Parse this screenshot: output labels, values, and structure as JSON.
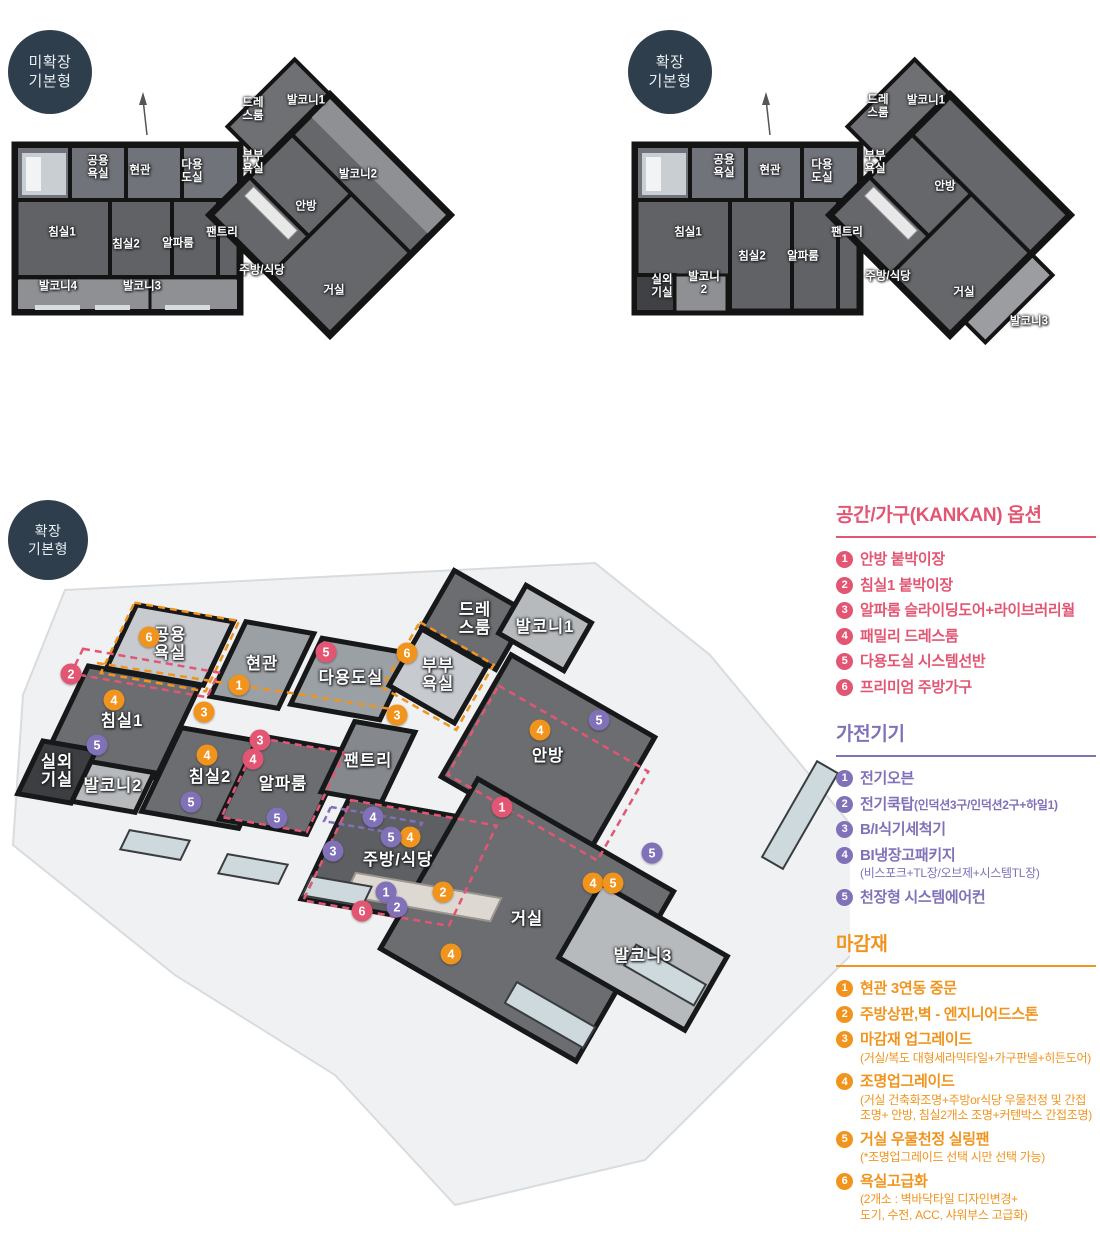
{
  "badges": {
    "plan1": "미확장\n기본형",
    "plan2": "확장\n기본형",
    "plan3": "확장\n기본형"
  },
  "plan1": {
    "labels": [
      {
        "t": "공용\n욕실",
        "x": 88,
        "y": 133
      },
      {
        "t": "현관",
        "x": 130,
        "y": 136
      },
      {
        "t": "다용\n도실",
        "x": 182,
        "y": 137
      },
      {
        "t": "드레\n스룸",
        "x": 243,
        "y": 75
      },
      {
        "t": "발코니1",
        "x": 296,
        "y": 66
      },
      {
        "t": "부부\n욕실",
        "x": 243,
        "y": 128
      },
      {
        "t": "발코니2",
        "x": 348,
        "y": 140
      },
      {
        "t": "안방",
        "x": 296,
        "y": 172
      },
      {
        "t": "침실1",
        "x": 52,
        "y": 198
      },
      {
        "t": "침실2",
        "x": 116,
        "y": 210
      },
      {
        "t": "알파룸",
        "x": 168,
        "y": 209
      },
      {
        "t": "팬트리",
        "x": 212,
        "y": 198
      },
      {
        "t": "주방/식당",
        "x": 252,
        "y": 236
      },
      {
        "t": "거실",
        "x": 324,
        "y": 256
      },
      {
        "t": "발코니4",
        "x": 48,
        "y": 252
      },
      {
        "t": "발코니3",
        "x": 132,
        "y": 252
      }
    ]
  },
  "plan2": {
    "labels": [
      {
        "t": "공용\n욕실",
        "x": 94,
        "y": 132
      },
      {
        "t": "현관",
        "x": 140,
        "y": 136
      },
      {
        "t": "다용\n도실",
        "x": 192,
        "y": 137
      },
      {
        "t": "드레\n스룸",
        "x": 248,
        "y": 72
      },
      {
        "t": "발코니1",
        "x": 296,
        "y": 66
      },
      {
        "t": "부부\n욕실",
        "x": 245,
        "y": 128
      },
      {
        "t": "안방",
        "x": 315,
        "y": 152
      },
      {
        "t": "침실1",
        "x": 58,
        "y": 198
      },
      {
        "t": "침실2",
        "x": 122,
        "y": 222
      },
      {
        "t": "알파룸",
        "x": 173,
        "y": 222
      },
      {
        "t": "팬트리",
        "x": 217,
        "y": 198
      },
      {
        "t": "실외\n기실",
        "x": 32,
        "y": 252
      },
      {
        "t": "발코니\n2",
        "x": 74,
        "y": 249
      },
      {
        "t": "주방/식당",
        "x": 258,
        "y": 242
      },
      {
        "t": "거실",
        "x": 334,
        "y": 258
      },
      {
        "t": "발코니3",
        "x": 399,
        "y": 287
      }
    ]
  },
  "iso": {
    "labels": [
      {
        "t": "공용\n욕실",
        "x": 165,
        "y": 100
      },
      {
        "t": "현관",
        "x": 257,
        "y": 120
      },
      {
        "t": "다용도실",
        "x": 346,
        "y": 134
      },
      {
        "t": "드레\n스룸",
        "x": 470,
        "y": 75
      },
      {
        "t": "발코니1",
        "x": 540,
        "y": 83
      },
      {
        "t": "부부\n욕실",
        "x": 433,
        "y": 131
      },
      {
        "t": "침실1",
        "x": 117,
        "y": 177
      },
      {
        "t": "실외\n기실",
        "x": 52,
        "y": 227
      },
      {
        "t": "발코니2",
        "x": 108,
        "y": 242
      },
      {
        "t": "침실2",
        "x": 205,
        "y": 233
      },
      {
        "t": "알파룸",
        "x": 278,
        "y": 240
      },
      {
        "t": "팬트리",
        "x": 363,
        "y": 217
      },
      {
        "t": "안방",
        "x": 543,
        "y": 212
      },
      {
        "t": "주방/식당",
        "x": 393,
        "y": 316
      },
      {
        "t": "거실",
        "x": 522,
        "y": 375
      },
      {
        "t": "발코니3",
        "x": 638,
        "y": 412
      }
    ],
    "markers": [
      {
        "g": "option",
        "n": 2,
        "x": 66,
        "y": 129
      },
      {
        "g": "option",
        "n": 5,
        "x": 321,
        "y": 107
      },
      {
        "g": "option",
        "n": 3,
        "x": 255,
        "y": 195
      },
      {
        "g": "option",
        "n": 4,
        "x": 248,
        "y": 214
      },
      {
        "g": "option",
        "n": 1,
        "x": 497,
        "y": 262
      },
      {
        "g": "option",
        "n": 6,
        "x": 357,
        "y": 366
      },
      {
        "g": "finish",
        "n": 6,
        "x": 144,
        "y": 92
      },
      {
        "g": "finish",
        "n": 1,
        "x": 234,
        "y": 140
      },
      {
        "g": "finish",
        "n": 3,
        "x": 199,
        "y": 167
      },
      {
        "g": "finish",
        "n": 6,
        "x": 402,
        "y": 108
      },
      {
        "g": "finish",
        "n": 3,
        "x": 392,
        "y": 170
      },
      {
        "g": "finish",
        "n": 4,
        "x": 109,
        "y": 155
      },
      {
        "g": "finish",
        "n": 4,
        "x": 202,
        "y": 210
      },
      {
        "g": "finish",
        "n": 4,
        "x": 535,
        "y": 185
      },
      {
        "g": "finish",
        "n": 4,
        "x": 405,
        "y": 292
      },
      {
        "g": "finish",
        "n": 2,
        "x": 438,
        "y": 347
      },
      {
        "g": "finish",
        "n": 4,
        "x": 446,
        "y": 409
      },
      {
        "g": "finish",
        "n": 4,
        "x": 588,
        "y": 338
      },
      {
        "g": "finish",
        "n": 5,
        "x": 608,
        "y": 338
      },
      {
        "g": "appliance",
        "n": 5,
        "x": 92,
        "y": 200
      },
      {
        "g": "appliance",
        "n": 5,
        "x": 186,
        "y": 257
      },
      {
        "g": "appliance",
        "n": 5,
        "x": 272,
        "y": 273
      },
      {
        "g": "appliance",
        "n": 5,
        "x": 594,
        "y": 175
      },
      {
        "g": "appliance",
        "n": 4,
        "x": 368,
        "y": 272
      },
      {
        "g": "appliance",
        "n": 5,
        "x": 386,
        "y": 292
      },
      {
        "g": "appliance",
        "n": 3,
        "x": 328,
        "y": 306
      },
      {
        "g": "appliance",
        "n": 1,
        "x": 381,
        "y": 347
      },
      {
        "g": "appliance",
        "n": 2,
        "x": 392,
        "y": 362
      },
      {
        "g": "appliance",
        "n": 5,
        "x": 647,
        "y": 308
      }
    ]
  },
  "legend": {
    "sections": [
      {
        "id": "option",
        "title": "공간/가구(KANKAN) 옵션",
        "color": "#e25673",
        "items": [
          {
            "num": 1,
            "text": "안방 붙박이장"
          },
          {
            "num": 2,
            "text": "침실1 붙박이장"
          },
          {
            "num": 3,
            "text": "알파룸 슬라이딩도어+라이브러리월"
          },
          {
            "num": 4,
            "text": "패밀리 드레스룸"
          },
          {
            "num": 5,
            "text": "다용도실 시스템선반"
          },
          {
            "num": 6,
            "text": "프리미엄 주방가구"
          }
        ]
      },
      {
        "id": "appliance",
        "title": "가전기기",
        "color": "#8171b8",
        "items": [
          {
            "num": 1,
            "text": "전기오븐"
          },
          {
            "num": 2,
            "text": "전기쿡탑",
            "inline_sub": "(인덕션3구/인덕션2구+하일1)"
          },
          {
            "num": 3,
            "text": "B/I식기세척기"
          },
          {
            "num": 4,
            "text": "BI냉장고패키지",
            "sub": "(비스포크+TL장/오브제+시스템TL장)"
          },
          {
            "num": 5,
            "text": "천장형 시스템에어컨"
          }
        ]
      },
      {
        "id": "finish",
        "title": "마감재",
        "color": "#f0941e",
        "items": [
          {
            "num": 1,
            "text": "현관 3연동 중문"
          },
          {
            "num": 2,
            "text": "주방상판,벽 - 엔지니어드스톤"
          },
          {
            "num": 3,
            "text": "마감재 업그레이드",
            "sub": "(거실/복도 대형세라믹타일+가구판넬+히든도어)"
          },
          {
            "num": 4,
            "text": "조명업그레이드",
            "sub": "(거실 건축화조명+주방or식당 우물천정 및 간접\n조명+ 안방, 침실2개소 조명+커텐박스 간접조명)"
          },
          {
            "num": 5,
            "text": "거실 우물천정 실링팬",
            "sub": "(*조명업그레이드 선택 시만 선택 가능)"
          },
          {
            "num": 6,
            "text": "욕실고급화",
            "sub": "(2개소 : 벽바닥타일 디자인변경+\n도기, 수전, ACC, 샤워부스 고급화)"
          }
        ]
      }
    ]
  }
}
